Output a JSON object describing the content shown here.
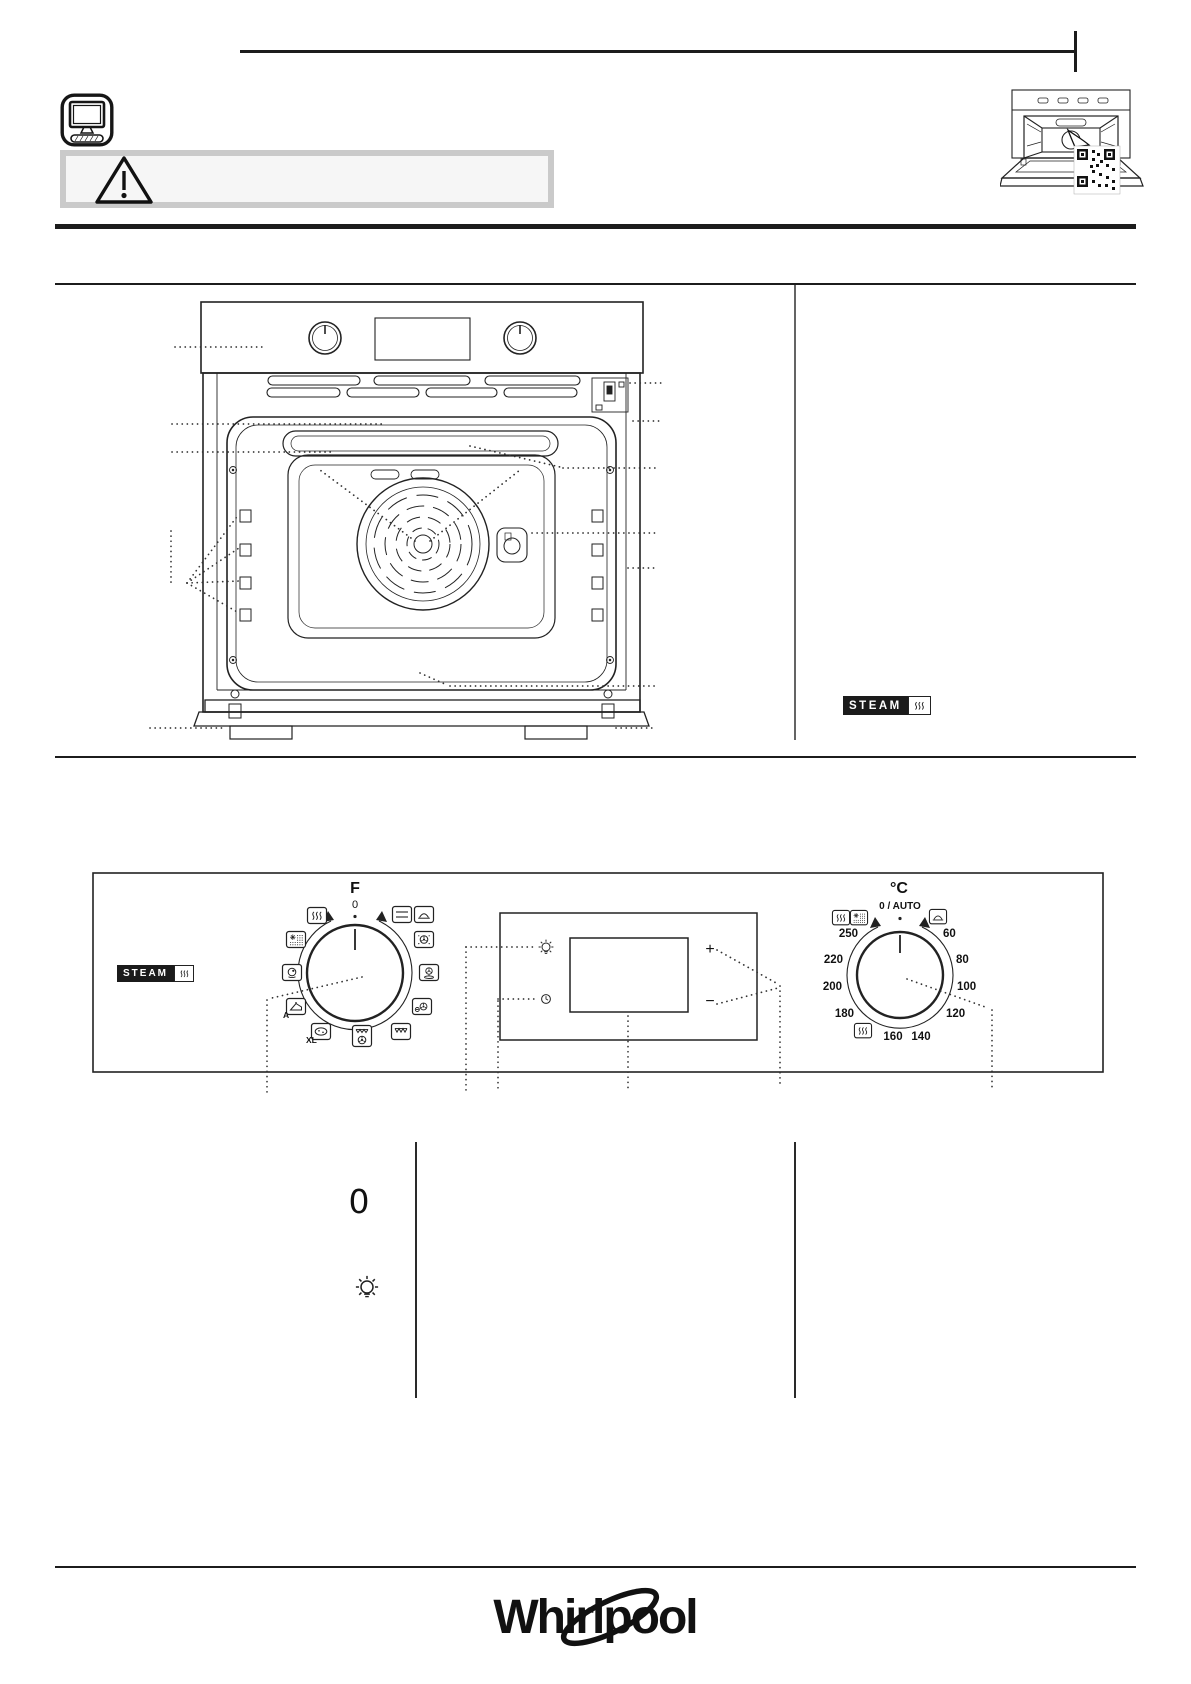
{
  "badges": {
    "oven_steam": "STEAM",
    "panel_steam": "STEAM"
  },
  "function_knob": {
    "label": "F",
    "zero": "0",
    "cake_auto_label": "A",
    "xl_label": "XL",
    "icons": [
      "steam",
      "defrost",
      "eco-steam",
      "cake-auto",
      "pizza-xl",
      "grill-fan",
      "grill",
      "eco-forced-air",
      "turbo-grill",
      "forced-air",
      "warming",
      "conventional"
    ]
  },
  "display": {
    "plus": "+",
    "minus": "−",
    "icons": [
      "oven-light",
      "timer-clock"
    ]
  },
  "temp_knob": {
    "label": "°C",
    "zero_auto": "0 / AUTO",
    "temps": [
      "250",
      "220",
      "200",
      "180",
      "160",
      "140",
      "120",
      "100",
      "80",
      "60"
    ],
    "icons": [
      "steam",
      "defrost",
      "warming",
      "steam-clean"
    ]
  },
  "legend": {
    "knob_zero": "0"
  },
  "footer": {
    "brand": "Whirlpool"
  }
}
